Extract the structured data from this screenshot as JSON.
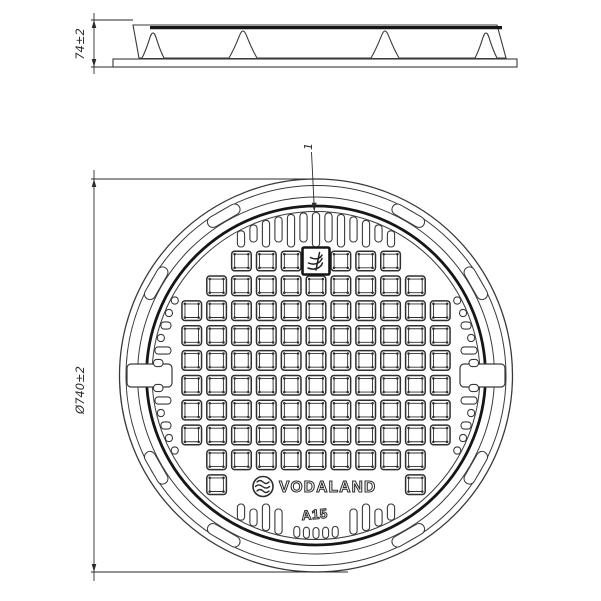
{
  "drawing": {
    "background": "#ffffff",
    "line_color": "#3a3a3a",
    "heavy_line_color": "#161616",
    "dim_color": "#2b2b2b",
    "side_view": {
      "height_dimension": "74±2",
      "rib_count": 4
    },
    "plan_view": {
      "diameter_dimension": "Ø740±2",
      "callout_label": "1",
      "brand_label": "VODALAND",
      "load_class_label": "A15",
      "rim_lug_count": 8,
      "pry_notch_count": 2,
      "comb_slots_per_side": 13,
      "bottom_nub_count": 5,
      "grid": {
        "rows": 10,
        "cols": 11
      }
    }
  }
}
